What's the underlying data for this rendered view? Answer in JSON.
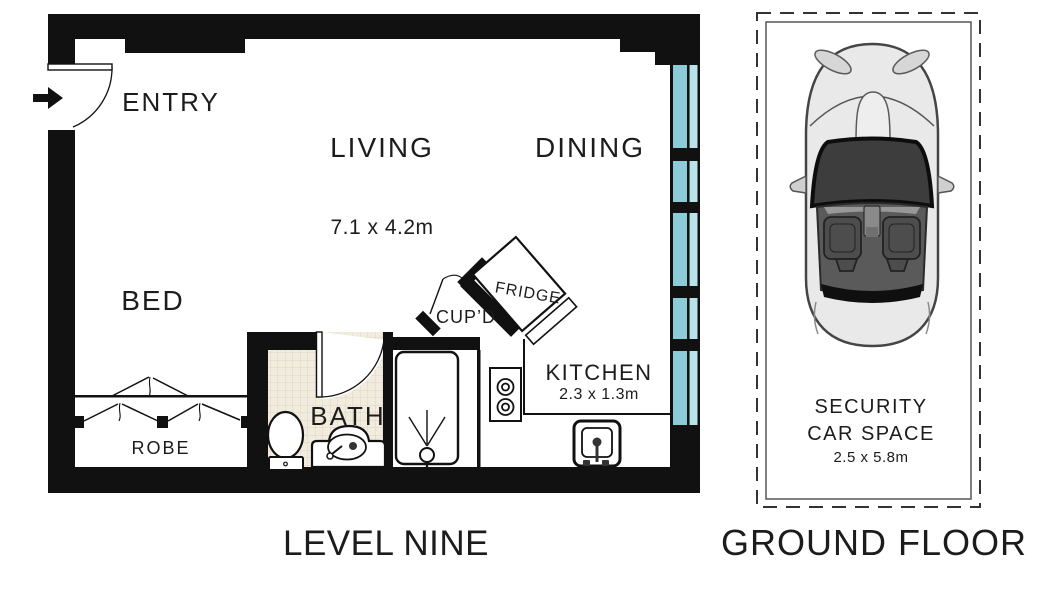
{
  "floor_plan": {
    "name_label": "LEVEL NINE",
    "rooms": {
      "entry": "ENTRY",
      "living": "LIVING",
      "living_dimensions": "7.1 x 4.2m",
      "dining": "DINING",
      "bed": "BED",
      "robe": "ROBE",
      "bath": "BATH",
      "cupboard": "CUP’D",
      "fridge": "FRIDGE",
      "kitchen": "KITCHEN",
      "kitchen_dimensions": "2.3 x 1.3m"
    }
  },
  "car_space": {
    "name_label": "GROUND FLOOR",
    "title_line1": "SECURITY",
    "title_line2": "CAR SPACE",
    "dimensions": "2.5 x 5.8m"
  },
  "colors": {
    "wall": "#111111",
    "text": "#1c1c1c",
    "window_glass": "#8ccbd8",
    "window_glass_light": "#bae2e9",
    "bath_tile": "#f2ecdf",
    "tile_grid": "#ded3c0",
    "car_body": "#e9e9e9",
    "car_windshield": "#3d3d3d",
    "car_cockpit": "#5a5a5a"
  }
}
